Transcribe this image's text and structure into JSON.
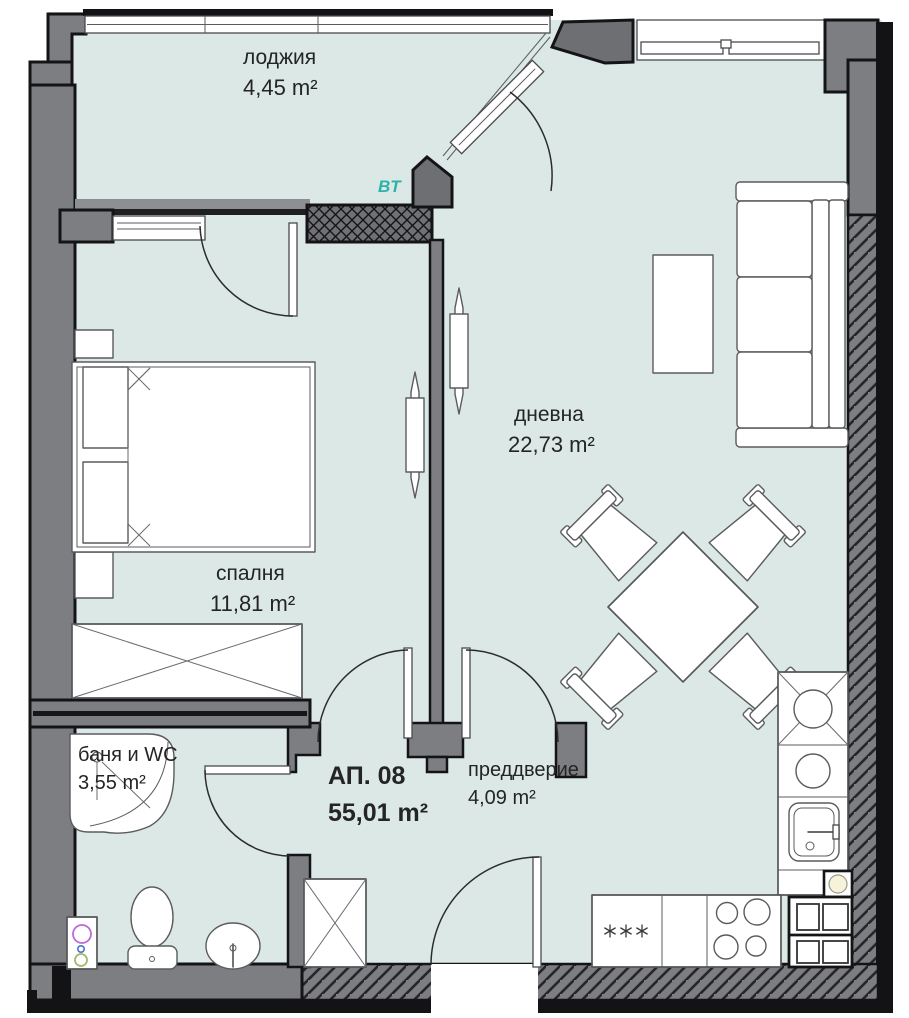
{
  "title": "Apartment floor plan",
  "apartment": {
    "label": "АП. 08",
    "area": "55,01 m²"
  },
  "rooms": {
    "loggia": {
      "name": "лоджия",
      "area": "4,45 m²"
    },
    "living": {
      "name": "дневна",
      "area": "22,73 m²"
    },
    "bedroom": {
      "name": "спалня",
      "area": "11,81 m²"
    },
    "bath": {
      "name": "баня и WC",
      "area": "3,55 m²"
    },
    "hall": {
      "name": "преддверие",
      "area": "4,09 m²"
    }
  },
  "annotations": {
    "bt": "BT"
  },
  "icons": {
    "cooker_symbols": "asterisk-x3",
    "washing_machine": "three-circles",
    "wardrobe": "crossed-box",
    "shaft": "circle-in-box"
  },
  "colors": {
    "floor": "#dbe8e5",
    "wall": "#7d7e82",
    "wall_outline": "#141416",
    "accent_teal": "#2ab3aa",
    "text": "#242424",
    "washer_magenta": "#c069d8",
    "washer_blue": "#4a6fd4",
    "washer_green": "#a4b86a"
  }
}
